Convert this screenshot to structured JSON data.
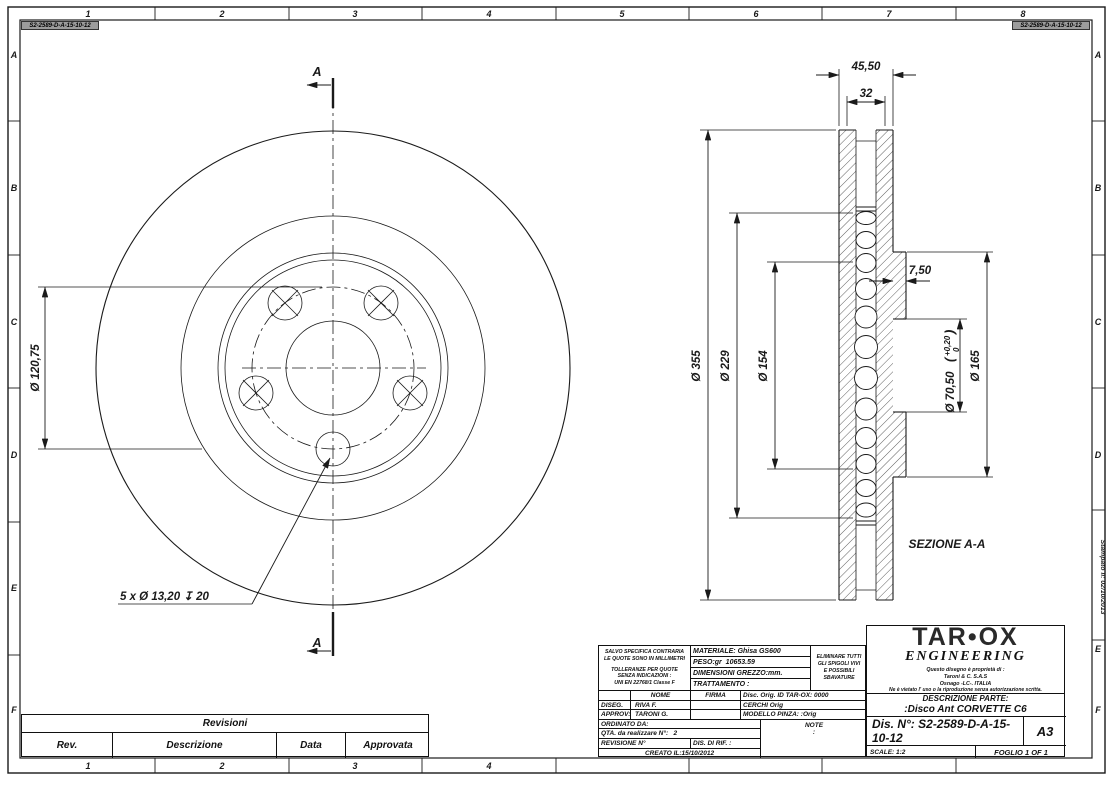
{
  "frame": {
    "columns": [
      "1",
      "2",
      "3",
      "4",
      "5",
      "6",
      "7",
      "8"
    ],
    "rows": [
      "A",
      "B",
      "C",
      "D",
      "E",
      "F"
    ],
    "drawing_number_tag": "S2-2589-D-A-15-10-12",
    "printed_note": "Stampato il: 02/10/2013"
  },
  "front_view": {
    "section_label": "A",
    "bolt_circle_dim": "Ø 120,75",
    "holes_note": "5 x Ø 13,20 ↧ 20"
  },
  "section_view": {
    "label": "SEZIONE A-A",
    "overall_width": "45,50",
    "vane_width": "32",
    "outer_dia": "Ø 355",
    "vent_dia": "Ø 229",
    "hat_dia": "Ø 154",
    "hat_wall": "7,50",
    "bore_dia": "Ø 70,50",
    "bore_tol_open": "(",
    "bore_tol_plus": "+0,20",
    "bore_tol_zero": "0",
    "bore_tol_close": ")",
    "flange_dia": "Ø 165"
  },
  "revisions": {
    "title": "Revisioni",
    "col_rev": "Rev.",
    "col_desc": "Descrizione",
    "col_data": "Data",
    "col_appr": "Approvata"
  },
  "spec": {
    "units_note_1": "SALVO SPECIFICA CONTRARIA",
    "units_note_2": "LE QUOTE SONO IN MILLIMETRI",
    "tol_note_1": "TOLLERANZE PER QUOTE",
    "tol_note_2": "SENZA INDICAZIONI :",
    "tol_note_3": "UNI EN 22768/1 Classe F",
    "material": "MATERIALE: Ghisa GS600",
    "weight": "PESO:gr  10653.59",
    "raw_dims": "DIMENSIONI GREZZO:mm.",
    "treatment": "TRATTAMENTO :",
    "deburr_1": "ELIMINARE TUTTI",
    "deburr_2": "GLI SPIGOLI VIVI",
    "deburr_3": "E POSSIBILI",
    "deburr_4": "SBAVATURE",
    "nome": "NOME",
    "firma": "FIRMA",
    "disc_orig": "Disc. Orig. ID TAR-OX: 0000",
    "diseg": "DISEG.",
    "diseg_name": "RIVA F.",
    "cerchi": "CERCHI Orig",
    "approv": "APPROV:",
    "approv_name": "TARONI G.",
    "modello": "MODELLO PINZA: :Orig",
    "ordinato": "ORDINATO DA:",
    "note_label": "NOTE",
    "note_value": ":",
    "qty": "QTA. da realizzare N°:   2",
    "revisione": "REVISIONE N°",
    "rif": "DIS. DI RIF. :",
    "created": "CREATO IL:15/10/2012"
  },
  "title_block": {
    "brand": "TAR•OX",
    "brand_sub": "ENGINEERING",
    "own_1": "Questo disegno è proprietà di :",
    "own_2": "Taroni & C. S.A.S",
    "own_3": "Osnago -LC-. ITALIA",
    "own_4": "Ne è vietato l' uso o la riproduzione senza autorizzazione scritta.",
    "part_label": "DESCRIZIONE PARTE:",
    "part_name": ":Disco Ant CORVETTE C6",
    "drawing_no": "Dis. N°: S2-2589-D-A-15-10-12",
    "format": "A3",
    "scale": "SCALE: 1:2",
    "sheet": "FOGLIO 1 OF 1"
  }
}
